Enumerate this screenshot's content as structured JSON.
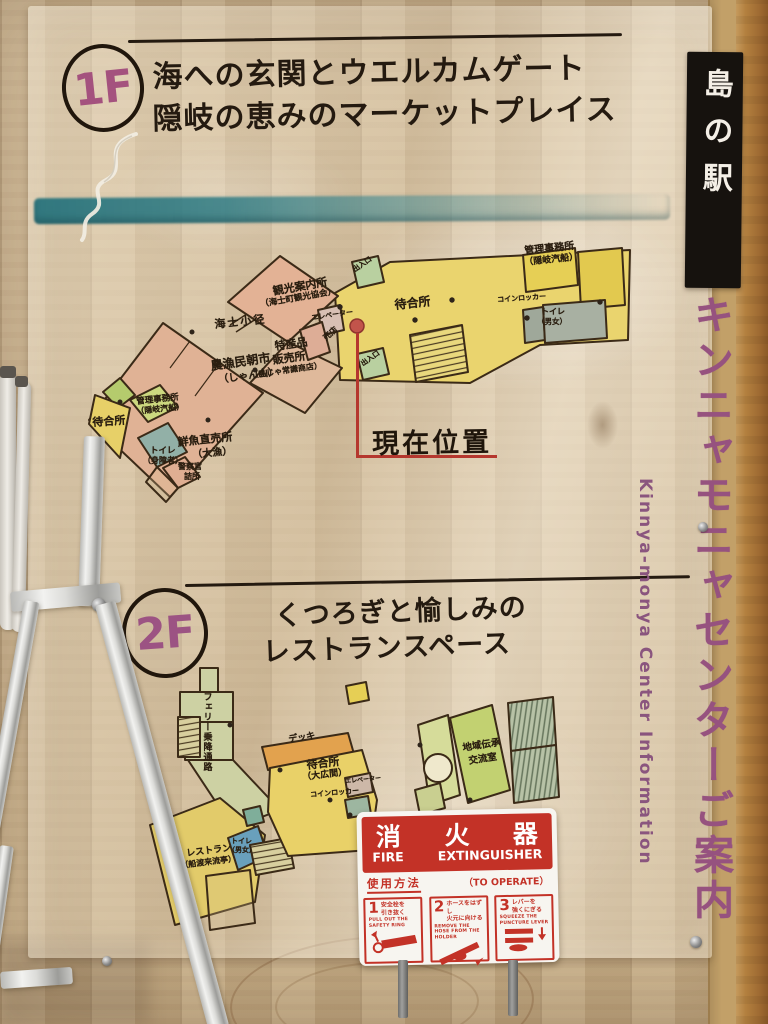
{
  "signboard": {
    "floor1": {
      "badge": "1F",
      "title_line1": "海への玄関とウエルカムゲート",
      "title_line2": "隠岐の恵みのマーケットプレイス",
      "map_labels": {
        "ama_path": "海士小径",
        "morning_market_line1": "農漁民朝市",
        "morning_market_line2": "（しゃん山）",
        "tourist_info_line1": "観光案内所",
        "tourist_info_line2": "（海士町観光協会）",
        "specialty_shop_line1": "特産品",
        "specialty_shop_line2": "販売所",
        "specialty_shop_line3": "（島じゃ常識商店）",
        "office_west_line1": "管理事務所",
        "office_west_line2": "（隠岐汽船）",
        "waiting_west": "待合所",
        "toilet_west_line1": "トイレ",
        "toilet_west_line2": "（身障者）",
        "police_line1": "警察官",
        "police_line2": "詰所",
        "fish_market_line1": "鮮魚直売所",
        "fish_market_line2": "（大漁）",
        "elevator": "エレベーター",
        "kiosk": "売店",
        "entrance_top": "出入口",
        "entrance_bottom": "出入口",
        "waiting_main": "待合所",
        "office_east_line1": "管理事務所",
        "office_east_line2": "（隠岐汽船）",
        "coin_locker": "コインロッカー",
        "toilet_east_line1": "トイレ",
        "toilet_east_line2": "（男女）"
      }
    },
    "current_location": "現在位置",
    "floor2": {
      "badge": "2F",
      "title_line1": "くつろぎと愉しみの",
      "title_line2": "レストランスペース",
      "map_labels": {
        "ferry_corridor": "フェリー乗降通路",
        "deck": "デッキ",
        "waiting_line1": "待合所",
        "waiting_line2": "（大広間）",
        "coin_locker": "コインロッカー",
        "elevator": "エレベーター",
        "community_room_line1": "地域伝承",
        "community_room_line2": "交流室",
        "restaurant_line1": "レストラン",
        "restaurant_line2": "（船渡来流亭）",
        "toilet_line1": "トイレ",
        "toilet_line2": "（男女）"
      }
    }
  },
  "side_signs": {
    "station_banner": "島の駅",
    "center_title_vertical": "キンニャモニャセンターご案内",
    "center_title_english": "Kinnya-monya Center Information"
  },
  "fire_sign": {
    "title_jp_char1": "消",
    "title_jp_char2": "火",
    "title_jp_char3": "器",
    "title_en_word1": "FIRE",
    "title_en_word2": "EXTINGUISHER",
    "usage_jp": "使用方法",
    "usage_en": "（TO OPERATE）",
    "steps": [
      {
        "number": "1",
        "jp_line1": "安全栓を",
        "jp_line2": "引き抜く",
        "en": "PULL OUT THE SAFETY RING"
      },
      {
        "number": "2",
        "jp_line1": "ホースをはずし",
        "jp_line2": "火元に向ける",
        "en": "REMOVE THE HOSE FROM THE HOLDER"
      },
      {
        "number": "3",
        "jp_line1": "レバーを",
        "jp_line2": "強くにぎる",
        "en": "SQUEEZE THE PUNCTURE LEVER"
      }
    ]
  }
}
